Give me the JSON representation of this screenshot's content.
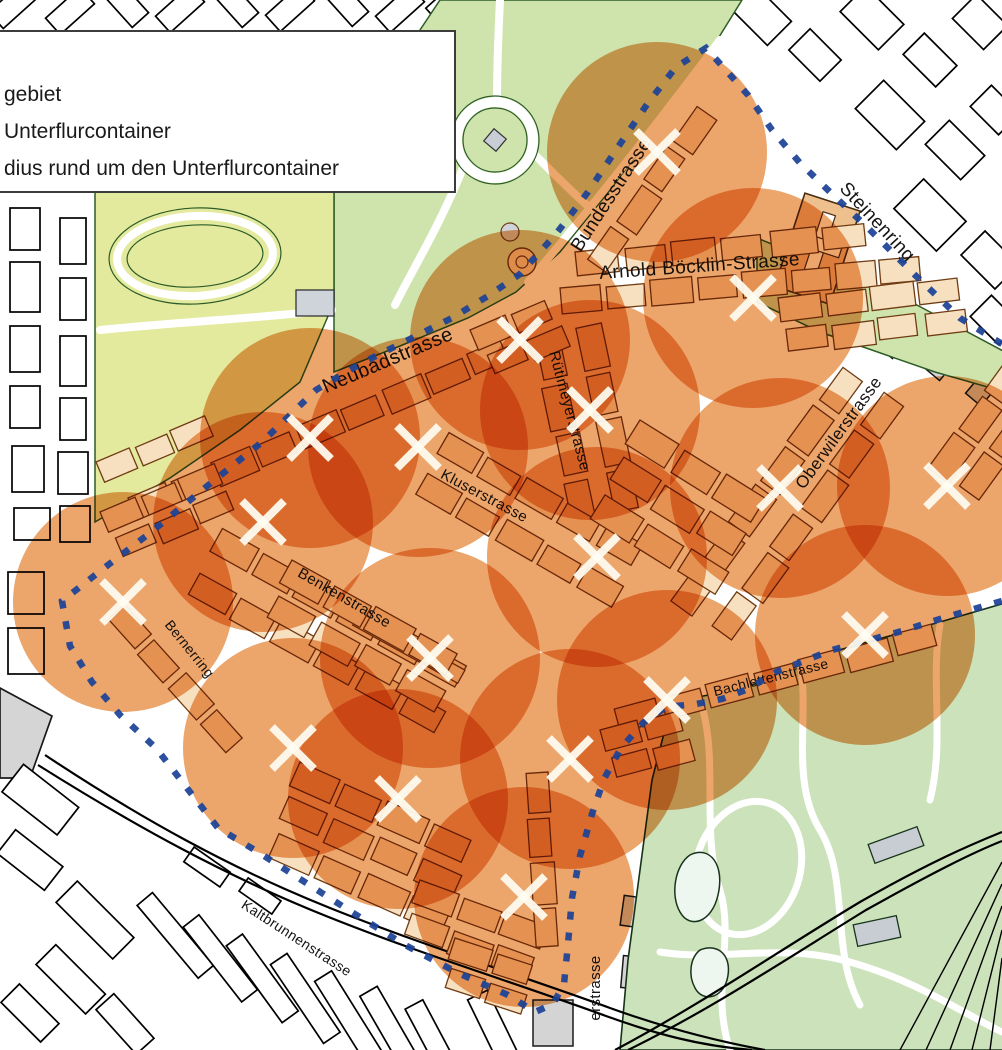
{
  "legend": {
    "items": [
      {
        "label": "gebiet"
      },
      {
        "label": "Unterflurcontainer"
      },
      {
        "label": "dius rund um den Unterflurcontainer"
      }
    ]
  },
  "map": {
    "street_labels": [
      {
        "name": "Bundesstrasse",
        "x": 616,
        "y": 198,
        "rotate": -57,
        "size": 19
      },
      {
        "name": "Steinenring",
        "x": 873,
        "y": 226,
        "rotate": 47,
        "size": 19
      },
      {
        "name": "Arnold Böcklin-Strasse",
        "x": 700,
        "y": 272,
        "rotate": -4,
        "size": 19
      },
      {
        "name": "Neubadstrasse",
        "x": 390,
        "y": 366,
        "rotate": -23,
        "size": 20
      },
      {
        "name": "Rütimeyerstrasse",
        "x": 565,
        "y": 412,
        "rotate": 75,
        "size": 15
      },
      {
        "name": "Oberwilerstrasse",
        "x": 843,
        "y": 436,
        "rotate": -54,
        "size": 17
      },
      {
        "name": "Kluserstrasse",
        "x": 482,
        "y": 500,
        "rotate": 28,
        "size": 15
      },
      {
        "name": "Benkenstrasse",
        "x": 342,
        "y": 602,
        "rotate": 30,
        "size": 15
      },
      {
        "name": "Bernerring",
        "x": 186,
        "y": 652,
        "rotate": 51,
        "size": 14
      },
      {
        "name": "Bachlettenstrasse",
        "x": 772,
        "y": 682,
        "rotate": -14,
        "size": 14
      },
      {
        "name": "Kaltbrunnenstrasse",
        "x": 294,
        "y": 942,
        "rotate": 33,
        "size": 14
      },
      {
        "name": "erstrasse",
        "x": 600,
        "y": 988,
        "rotate": -90,
        "size": 15
      }
    ],
    "containers": [
      [
        657,
        152
      ],
      [
        753,
        298
      ],
      [
        520,
        340
      ],
      [
        590,
        410
      ],
      [
        310,
        438
      ],
      [
        418,
        447
      ],
      [
        263,
        522
      ],
      [
        123,
        602
      ],
      [
        780,
        488
      ],
      [
        947,
        486
      ],
      [
        597,
        557
      ],
      [
        430,
        658
      ],
      [
        865,
        635
      ],
      [
        667,
        700
      ],
      [
        570,
        759
      ],
      [
        293,
        748
      ],
      [
        398,
        799
      ],
      [
        524,
        897
      ]
    ],
    "radius_px": 110,
    "boundary_points": [
      [
        1002,
        344
      ],
      [
        960,
        318
      ],
      [
        915,
        275
      ],
      [
        868,
        228
      ],
      [
        830,
        192
      ],
      [
        800,
        163
      ],
      [
        772,
        130
      ],
      [
        748,
        95
      ],
      [
        706,
        48
      ],
      [
        676,
        67
      ],
      [
        648,
        103
      ],
      [
        618,
        147
      ],
      [
        588,
        192
      ],
      [
        556,
        234
      ],
      [
        520,
        274
      ],
      [
        488,
        296
      ],
      [
        452,
        318
      ],
      [
        408,
        340
      ],
      [
        360,
        364
      ],
      [
        316,
        390
      ],
      [
        262,
        442
      ],
      [
        206,
        487
      ],
      [
        150,
        533
      ],
      [
        108,
        565
      ],
      [
        62,
        601
      ],
      [
        70,
        646
      ],
      [
        92,
        682
      ],
      [
        120,
        715
      ],
      [
        156,
        748
      ],
      [
        190,
        792
      ],
      [
        218,
        828
      ],
      [
        258,
        852
      ],
      [
        300,
        879
      ],
      [
        350,
        911
      ],
      [
        405,
        945
      ],
      [
        458,
        973
      ],
      [
        508,
        995
      ],
      [
        535,
        1012
      ],
      [
        553,
        1004
      ],
      [
        564,
        984
      ],
      [
        568,
        944
      ],
      [
        572,
        898
      ],
      [
        580,
        856
      ],
      [
        592,
        814
      ],
      [
        604,
        779
      ],
      [
        621,
        748
      ],
      [
        643,
        723
      ],
      [
        666,
        707
      ],
      [
        696,
        704
      ],
      [
        722,
        699
      ],
      [
        748,
        689
      ],
      [
        776,
        672
      ],
      [
        804,
        661
      ],
      [
        832,
        650
      ],
      [
        866,
        641
      ],
      [
        902,
        631
      ],
      [
        940,
        619
      ],
      [
        974,
        609
      ],
      [
        1002,
        601
      ]
    ],
    "colors": {
      "radius_fill": "#e06e10",
      "boundary": "#1c4397",
      "container_mark": "#fffdf2",
      "park_green": "#cfe4ad",
      "field_green": "#e3ea9e",
      "zoo_green": "#cbe2ba",
      "building_tan": "#f7e0c0",
      "building_outline": "#6f3b12"
    }
  }
}
